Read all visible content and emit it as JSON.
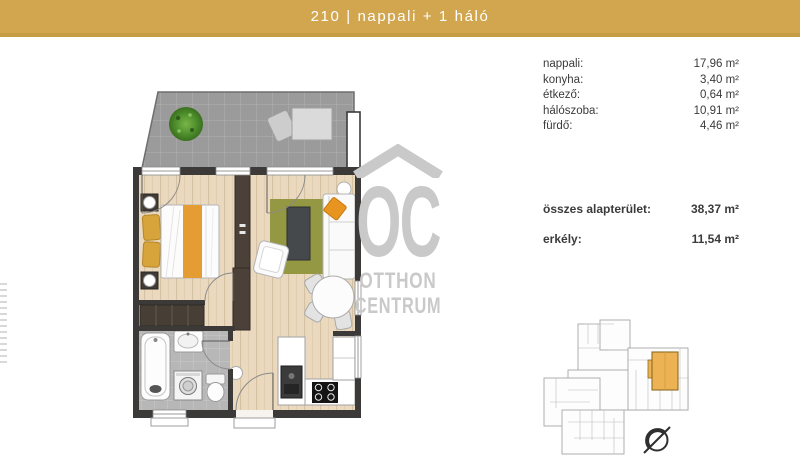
{
  "header": {
    "title": "210 | nappali + 1 háló"
  },
  "area_table": {
    "rows": [
      {
        "label": "nappali:",
        "value": "17,96 m²"
      },
      {
        "label": "konyha:",
        "value": "3,40 m²"
      },
      {
        "label": "étkező:",
        "value": "0,64 m²"
      },
      {
        "label": "hálószoba:",
        "value": "10,91 m²"
      },
      {
        "label": "fürdő:",
        "value": "4,46 m²"
      }
    ],
    "totals": [
      {
        "label": "összes alapterület:",
        "value": "38,37 m²"
      },
      {
        "label": "erkély:",
        "value": "11,54 m²"
      }
    ]
  },
  "watermark": {
    "monogram": "OC",
    "line1": "OTTHON",
    "line2": "CENTRUM"
  },
  "colors": {
    "accent_gold": "#d1a64f",
    "highlighted_unit_gold": "#ecb254",
    "watermark_gray": "#c9c9c9",
    "wall_dark": "#3c3a38",
    "wood_floor": "#ead9be",
    "rug_olive": "#949843",
    "pillow_orange": "#e79420"
  }
}
